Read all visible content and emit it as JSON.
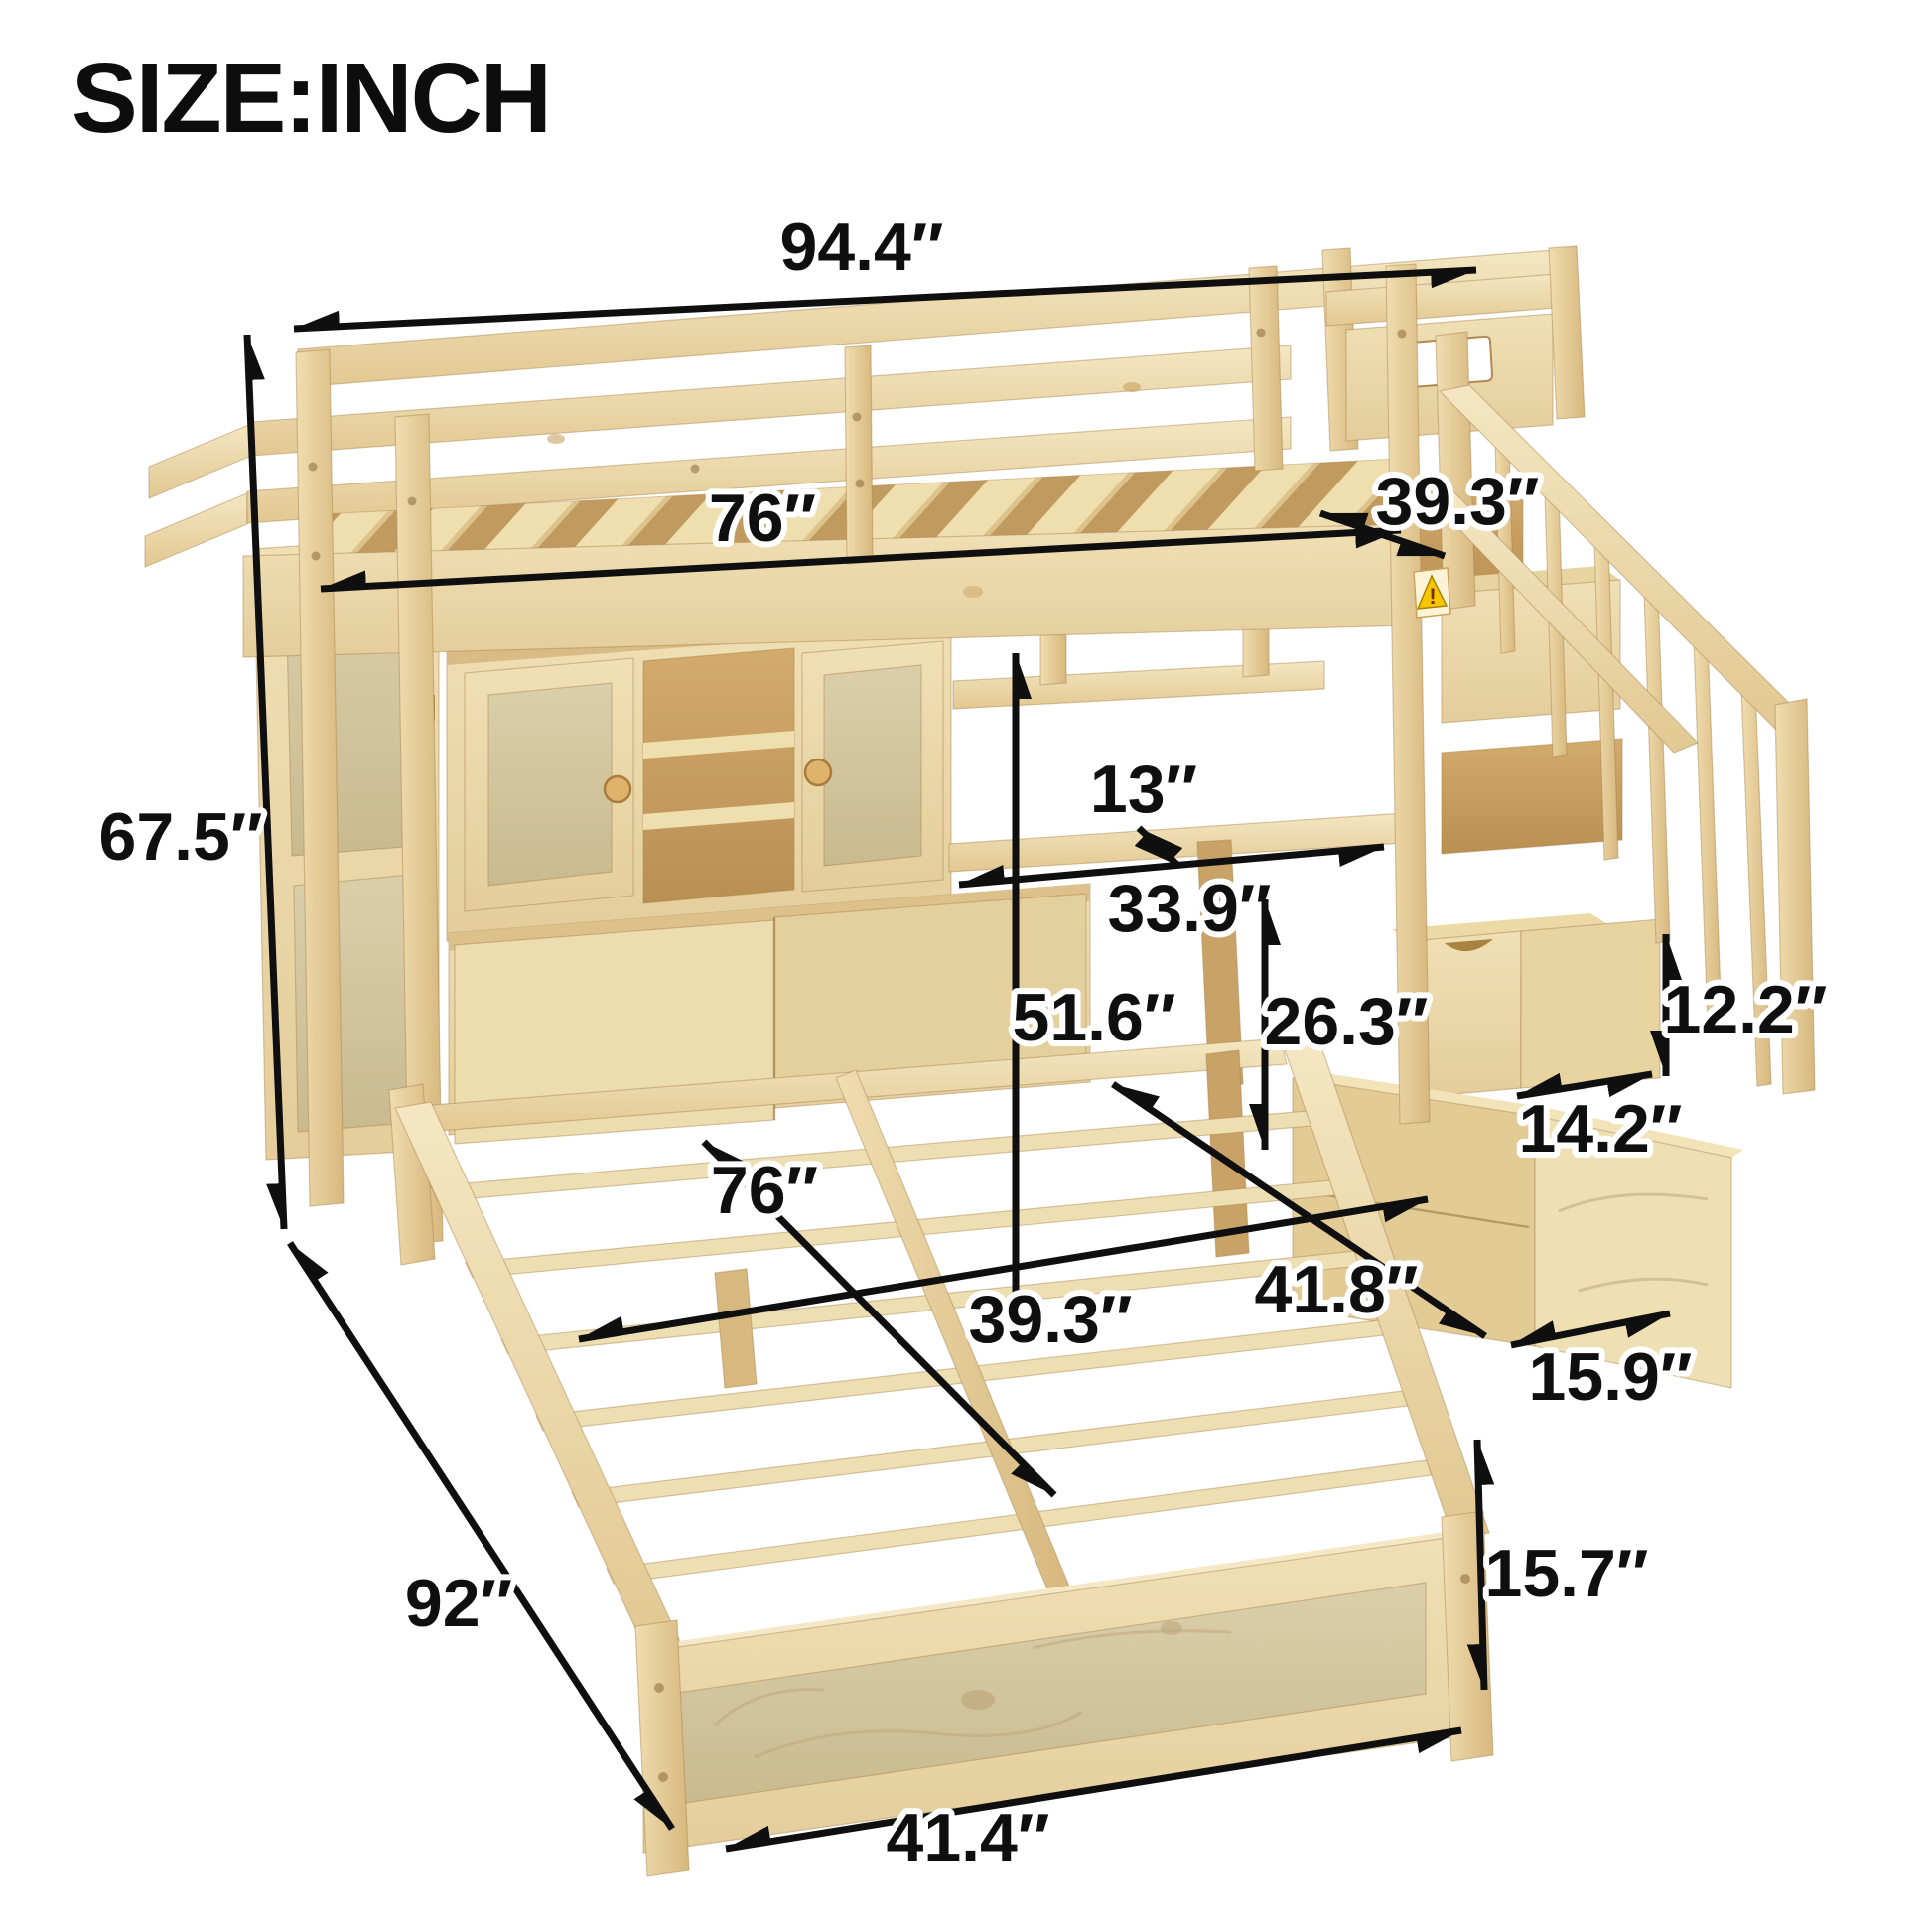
{
  "title": "SIZE:INCH",
  "dims": {
    "overall_length": "94.4″",
    "overall_height": "67.5″",
    "upper_bed_length": "76″",
    "upper_bed_width": "39.3″",
    "desk_shelf_depth": "13″",
    "desk_width": "33.9″",
    "under_loft_clearance": "51.6″",
    "desk_height": "26.3″",
    "step_height": "12.2″",
    "step_depth": "14.2″",
    "staircase_depth": "41.8″",
    "staircase_width": "15.9″",
    "lower_bed_length": "76″",
    "lower_bed_width": "39.3″",
    "lower_bed_total_length": "92″",
    "footboard_width": "41.4″",
    "lower_bed_height": "15.7″"
  },
  "warning_glyph": "!"
}
